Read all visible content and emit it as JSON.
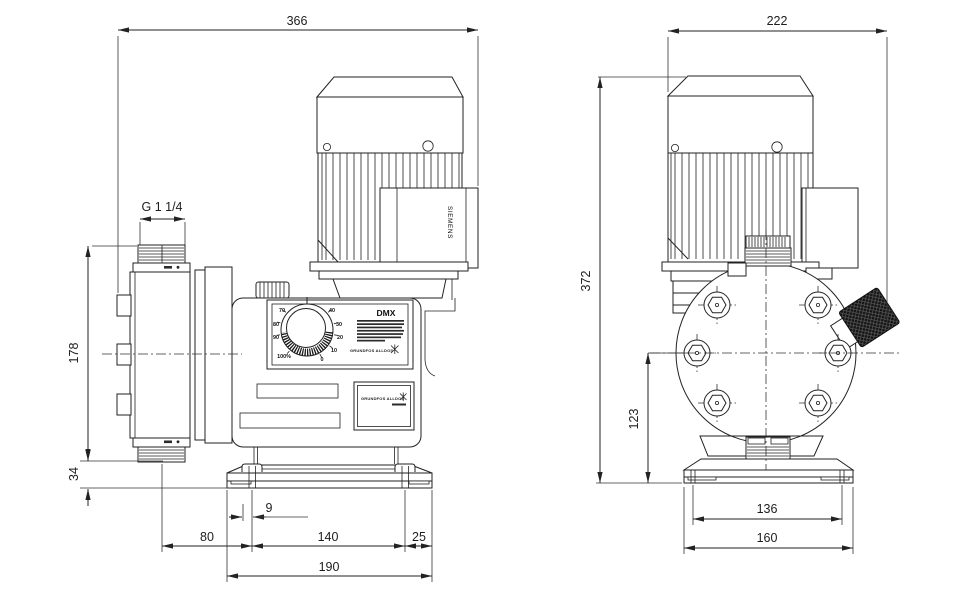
{
  "side_view": {
    "model_label": "DMX",
    "motor_brand": "SIEMENS",
    "panel_logo": "GRUNDFOS ALLDOS",
    "nameplate_logo": "GRUNDFOS ALLDOS",
    "dial": {
      "labels": {
        "l0": "0",
        "l10": "10",
        "l20": "20",
        "l30": "30",
        "l40": "40",
        "l70": "70",
        "l80": "80",
        "l90": "90",
        "l100": "100%"
      }
    },
    "dims": {
      "overall_width": "366",
      "thread": "G 1 1/4",
      "head_height": "178",
      "base_height": "34",
      "slot_offset": "9",
      "center_to_foot": "80",
      "foot_spacing": "140",
      "foot_to_edge": "25",
      "base_width": "190"
    }
  },
  "front_view": {
    "dims": {
      "overall_width": "222",
      "overall_height": "372",
      "center_to_base": "123",
      "foot_spacing": "136",
      "base_width": "160"
    }
  }
}
